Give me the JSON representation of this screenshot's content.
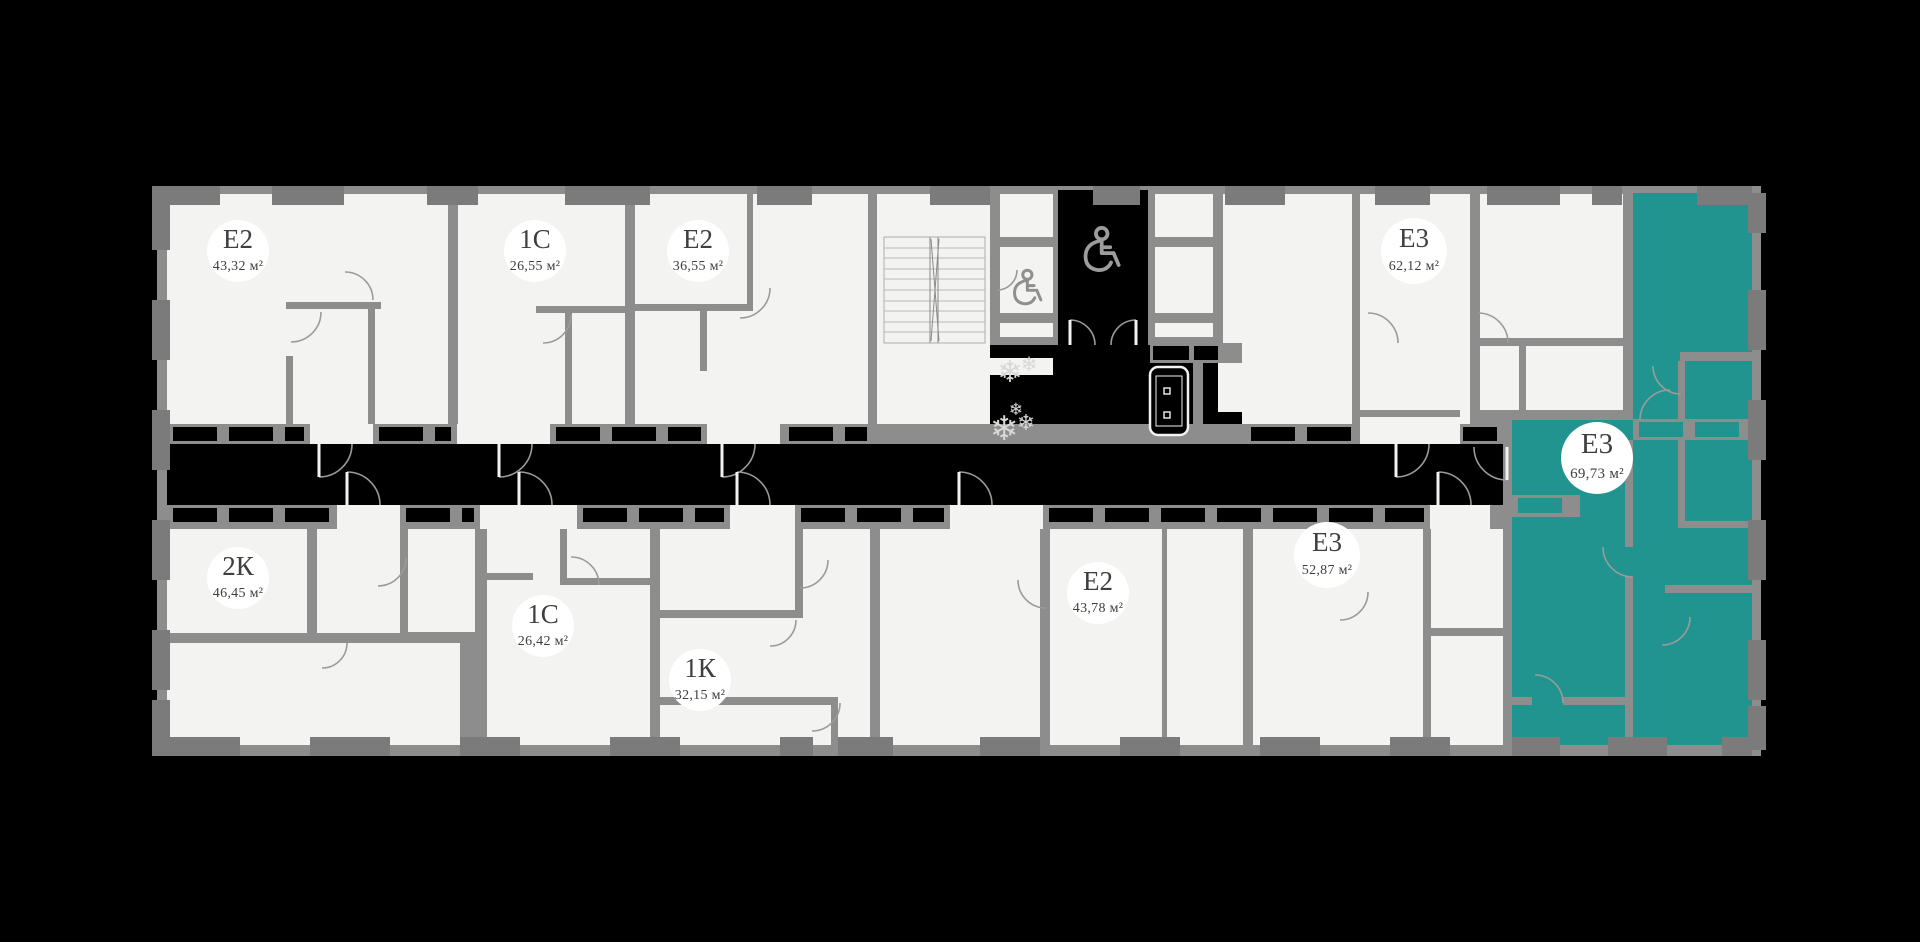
{
  "page": {
    "background": "#000000"
  },
  "colors": {
    "floor": "#f3f3f1",
    "wall": "#8d8d8d",
    "wall_dark": "#7b7b7b",
    "corridor": "#000000",
    "highlight": "#21948f",
    "label_circle": "#ffffff",
    "label_text": "#3e3e3e",
    "door": "#9b9b9b"
  },
  "apartments": [
    {
      "id": "a1",
      "type": "Е2",
      "area": "43,32 м²",
      "highlighted": false
    },
    {
      "id": "a2",
      "type": "1С",
      "area": "26,55 м²",
      "highlighted": false
    },
    {
      "id": "a3",
      "type": "Е2",
      "area": "36,55 м²",
      "highlighted": false
    },
    {
      "id": "a4",
      "type": "Е3",
      "area": "62,12 м²",
      "highlighted": false
    },
    {
      "id": "a5",
      "type": "Е3",
      "area": "69,73 м²",
      "highlighted": true
    },
    {
      "id": "b1",
      "type": "2К",
      "area": "46,45 м²",
      "highlighted": false
    },
    {
      "id": "b2",
      "type": "1С",
      "area": "26,42 м²",
      "highlighted": false
    },
    {
      "id": "b3",
      "type": "1К",
      "area": "32,15 м²",
      "highlighted": false
    },
    {
      "id": "b4",
      "type": "Е2",
      "area": "43,78 м²",
      "highlighted": false
    },
    {
      "id": "b5",
      "type": "Е3",
      "area": "52,87 м²",
      "highlighted": false
    }
  ],
  "icons": {
    "accessible_icon": "wheelchair",
    "plant_glyph": "❄",
    "bench_icon": "lobby-bench",
    "stairs_icon": "staircase"
  }
}
